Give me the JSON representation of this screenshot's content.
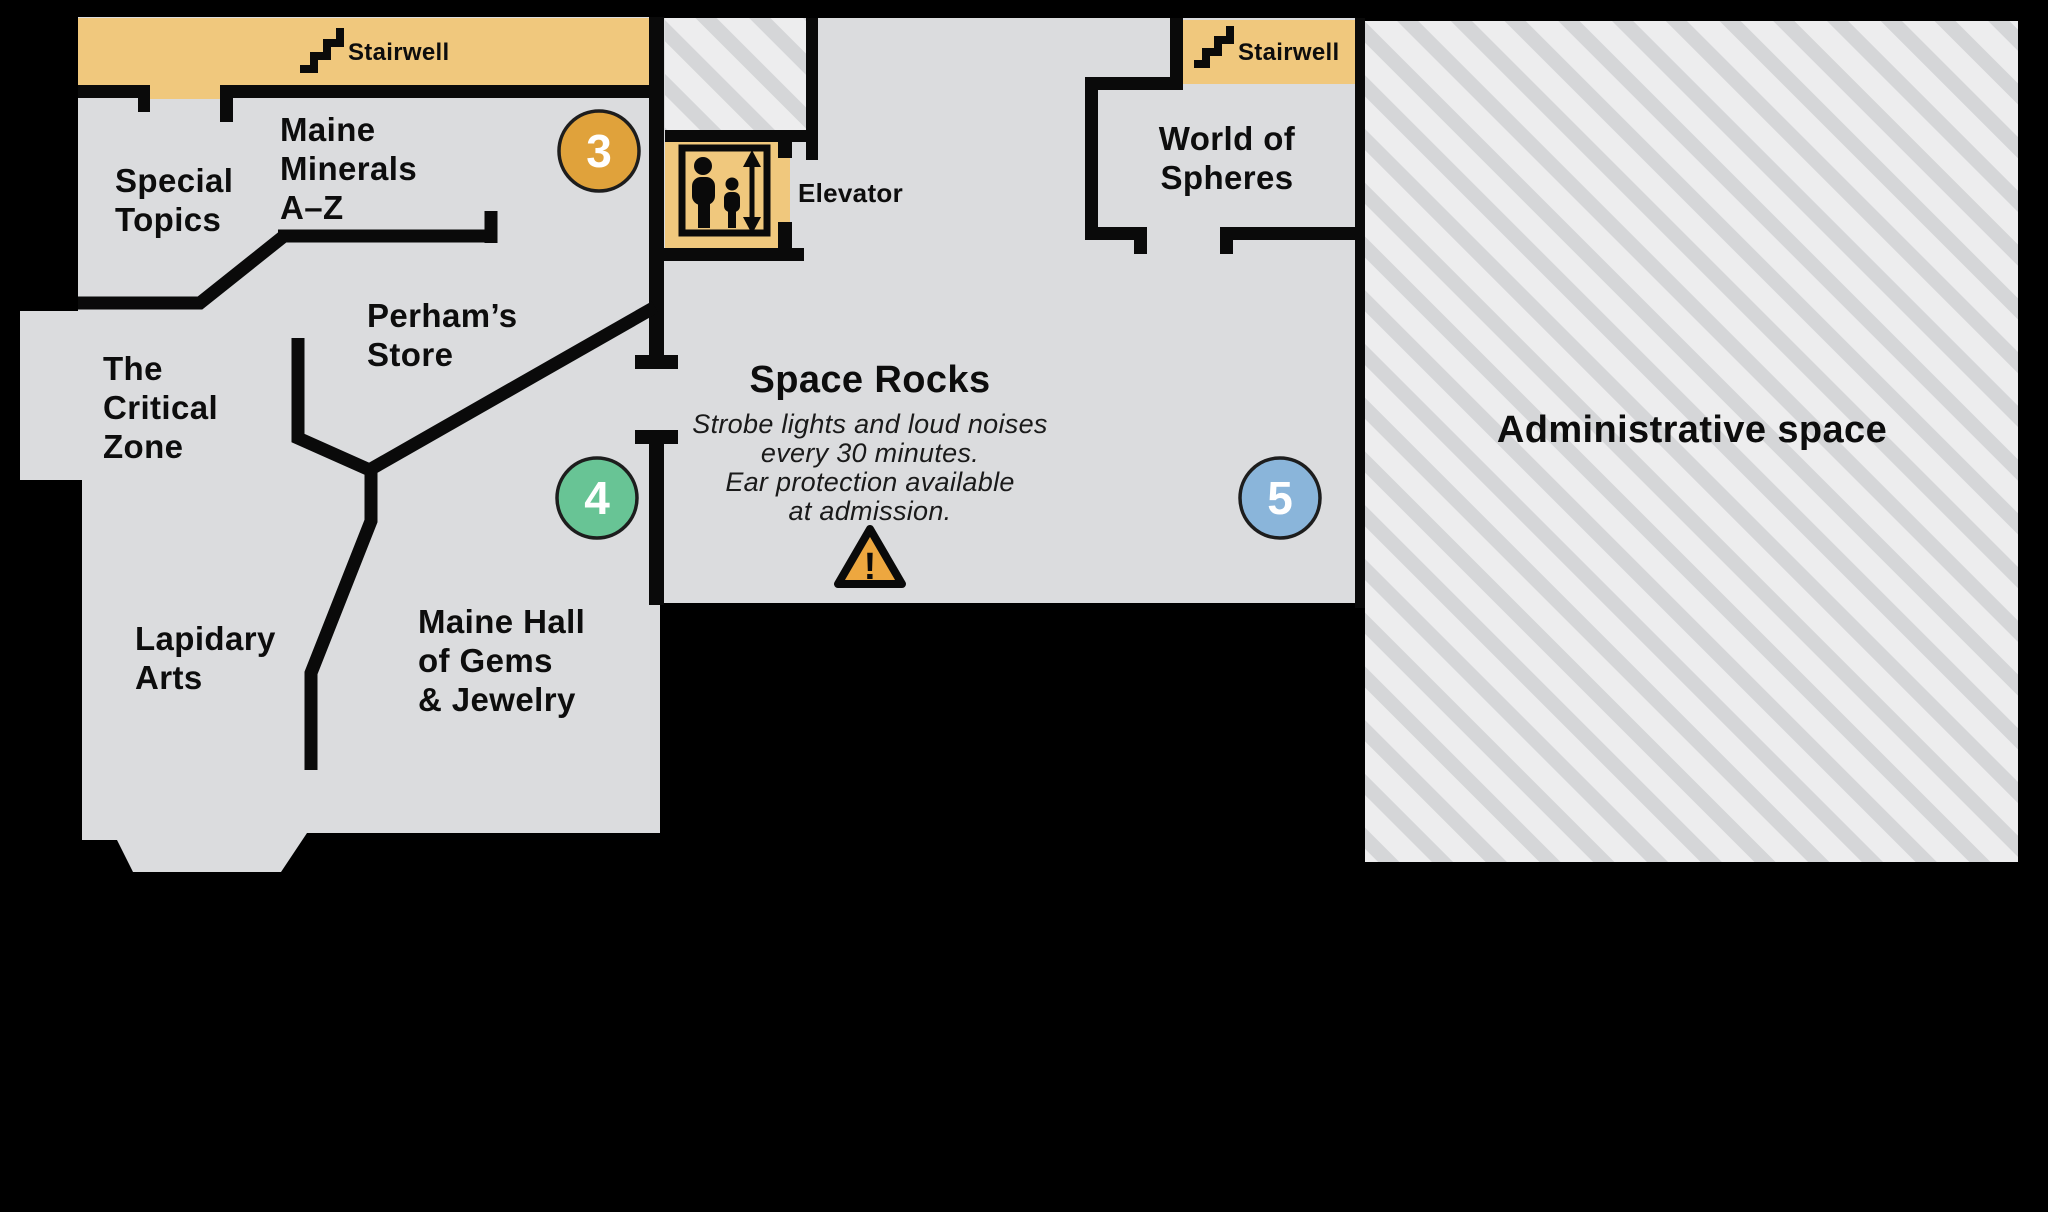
{
  "colors": {
    "background": "#000000",
    "floor": "#dbdcde",
    "wall": "#0a0a0a",
    "stairwell_tan": "#f0c87d",
    "hatch_background": "#ededee",
    "hatch_stripe": "#d5d6d8",
    "marker_3": "#e0a23b",
    "marker_4": "#68c495",
    "marker_5": "#8ab5da",
    "warning_triangle": "#eda73f",
    "label_text": "#0d0d0d"
  },
  "rooms": {
    "special_topics": {
      "lines": [
        "Special",
        "Topics"
      ]
    },
    "maine_minerals": {
      "lines": [
        "Maine",
        "Minerals",
        "A–Z"
      ]
    },
    "perhams_store": {
      "lines": [
        "Perham’s",
        "Store"
      ]
    },
    "critical_zone": {
      "lines": [
        "The",
        "Critical",
        "Zone"
      ]
    },
    "lapidary_arts": {
      "lines": [
        "Lapidary",
        "Arts"
      ]
    },
    "maine_hall": {
      "lines": [
        "Maine Hall",
        "of Gems",
        "& Jewelry"
      ]
    },
    "world_of_spheres": {
      "lines": [
        "World of",
        "Spheres"
      ]
    },
    "space_rocks": {
      "title": "Space Rocks",
      "warning_lines": [
        "Strobe lights and loud noises",
        "every 30 minutes.",
        "Ear protection available",
        "at admission."
      ]
    },
    "administrative": {
      "label": "Administrative space"
    }
  },
  "facilities": {
    "stairwell_left": "Stairwell",
    "stairwell_right": "Stairwell",
    "elevator": "Elevator"
  },
  "markers": [
    {
      "number": "3",
      "color": "#e0a23b"
    },
    {
      "number": "4",
      "color": "#68c495"
    },
    {
      "number": "5",
      "color": "#8ab5da"
    }
  ],
  "warning_icon": "!"
}
